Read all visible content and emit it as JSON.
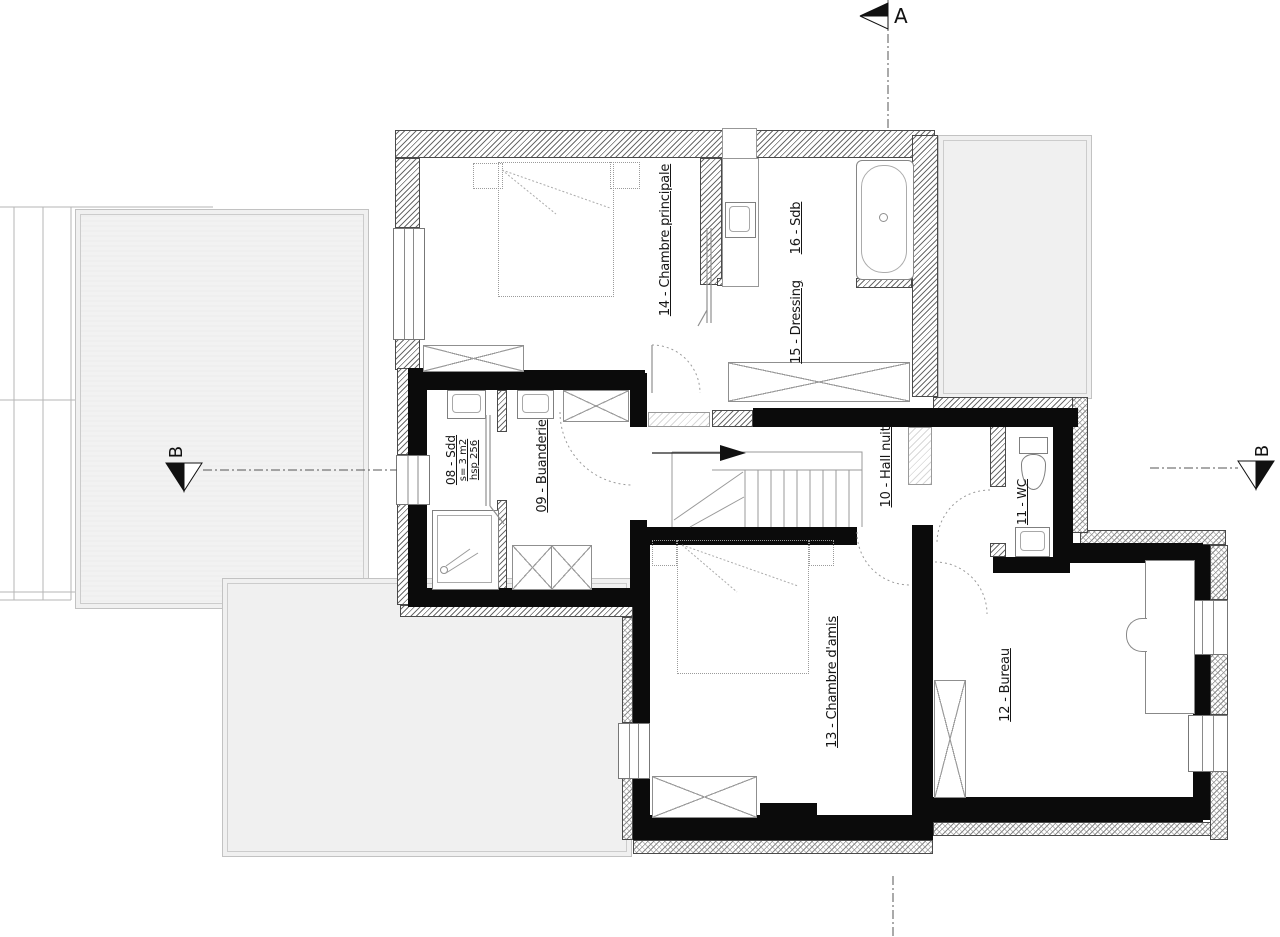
{
  "markers": {
    "a": "A",
    "b": "B"
  },
  "rooms": [
    {
      "id": "08",
      "label": "08 - Sdd",
      "area": "s= 3 m2",
      "ceiling": "hsp 256"
    },
    {
      "id": "09",
      "label": "09 - Buanderie"
    },
    {
      "id": "10",
      "label": "10 - Hall nuit"
    },
    {
      "id": "11",
      "label": "11 - WC"
    },
    {
      "id": "12",
      "label": "12 - Bureau"
    },
    {
      "id": "13",
      "label": "13 - Chambre d'amis"
    },
    {
      "id": "14",
      "label": "14 - Chambre principale"
    },
    {
      "id": "15",
      "label": "15 - Dressing"
    },
    {
      "id": "16",
      "label": "16 - Sdb"
    }
  ],
  "colors": {
    "wall": "#0b0b0b",
    "hatch_line": "#6b6b6b",
    "terrace_fill": "#f0f0f0",
    "drawing_line": "#999999",
    "text": "#151515"
  }
}
